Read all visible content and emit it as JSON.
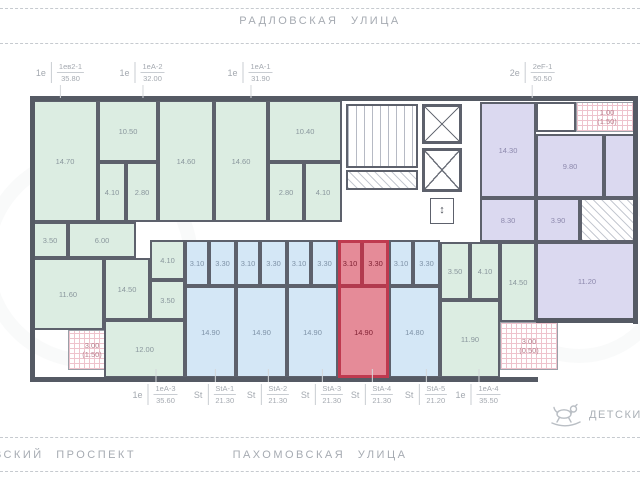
{
  "streets": {
    "top": "РАДЛОВСКАЯ УЛИЦА",
    "bottom_left": "ВСКИЙ ПРОСПЕКТ",
    "bottom_center": "ПАХОМОВСКАЯ УЛИЦА"
  },
  "poi": {
    "label": "ДЕТСКИЙ",
    "icon": "rocking-horse-icon"
  },
  "colors": {
    "green_room": "#dcede2",
    "blue_room": "#d4e7f6",
    "purple_room": "#dbd9f0",
    "highlight_red": "#e58b98",
    "highlight_border": "#bf3a4f",
    "wall": "#555a64",
    "street_text": "#a6abb2"
  },
  "top_units": [
    {
      "type": "1е",
      "code": "1ев2-1",
      "area": "35.80",
      "cx": 60
    },
    {
      "type": "1е",
      "code": "1еА-2",
      "area": "32.00",
      "cx": 142
    },
    {
      "type": "1е",
      "code": "1еА-1",
      "area": "31.90",
      "cx": 250
    },
    {
      "type": "2е",
      "code": "2еF-1",
      "area": "50.50",
      "cx": 532
    }
  ],
  "bottom_units": [
    {
      "type": "1е",
      "code": "1еА-3",
      "area": "35.60",
      "cx": 155
    },
    {
      "type": "St",
      "code": "StА-1",
      "area": "21.30",
      "cx": 215
    },
    {
      "type": "St",
      "code": "StА-2",
      "area": "21.30",
      "cx": 268
    },
    {
      "type": "St",
      "code": "StА-3",
      "area": "21.30",
      "cx": 322
    },
    {
      "type": "St",
      "code": "StА-4",
      "area": "21.30",
      "cx": 372
    },
    {
      "type": "St",
      "code": "StА-5",
      "area": "21.20",
      "cx": 426
    },
    {
      "type": "1е",
      "code": "1еА-4",
      "area": "35.50",
      "cx": 478
    }
  ],
  "plan": {
    "rooms": [
      {
        "t": "14.70",
        "x": 32,
        "y": 100,
        "w": 66,
        "h": 122,
        "c": "green"
      },
      {
        "t": "10.50",
        "x": 98,
        "y": 100,
        "w": 60,
        "h": 62,
        "c": "green"
      },
      {
        "t": "4.10",
        "x": 98,
        "y": 162,
        "w": 28,
        "h": 60,
        "c": "green"
      },
      {
        "t": "2.80",
        "x": 126,
        "y": 162,
        "w": 32,
        "h": 60,
        "c": "green"
      },
      {
        "t": "14.60",
        "x": 158,
        "y": 100,
        "w": 56,
        "h": 122,
        "c": "green"
      },
      {
        "t": "14.60",
        "x": 214,
        "y": 100,
        "w": 54,
        "h": 122,
        "c": "green"
      },
      {
        "t": "10.40",
        "x": 268,
        "y": 100,
        "w": 74,
        "h": 62,
        "c": "green"
      },
      {
        "t": "2.80",
        "x": 268,
        "y": 162,
        "w": 36,
        "h": 60,
        "c": "green"
      },
      {
        "t": "4.10",
        "x": 304,
        "y": 162,
        "w": 38,
        "h": 60,
        "c": "green"
      },
      {
        "t": "",
        "x": 346,
        "y": 104,
        "w": 72,
        "h": 64,
        "c": "stairs"
      },
      {
        "t": "",
        "x": 346,
        "y": 170,
        "w": 72,
        "h": 20,
        "c": "hatch"
      },
      {
        "t": "",
        "x": 422,
        "y": 104,
        "w": 40,
        "h": 40,
        "c": "elev"
      },
      {
        "t": "",
        "x": 422,
        "y": 148,
        "w": 40,
        "h": 44,
        "c": "elev"
      },
      {
        "t": "↕",
        "x": 430,
        "y": 198,
        "w": 24,
        "h": 26,
        "c": "sign"
      },
      {
        "t": "14.30",
        "x": 480,
        "y": 102,
        "w": 56,
        "h": 96,
        "c": "purple"
      },
      {
        "t": "",
        "x": 536,
        "y": 102,
        "w": 40,
        "h": 30,
        "c": "white"
      },
      {
        "t": "1.00|(1.50)",
        "x": 576,
        "y": 102,
        "w": 62,
        "h": 30,
        "c": "hatchpink"
      },
      {
        "t": "9.80",
        "x": 536,
        "y": 134,
        "w": 68,
        "h": 64,
        "c": "purple"
      },
      {
        "t": "",
        "x": 604,
        "y": 134,
        "w": 34,
        "h": 64,
        "c": "purple"
      },
      {
        "t": "8.30",
        "x": 480,
        "y": 198,
        "w": 56,
        "h": 44,
        "c": "purple"
      },
      {
        "t": "3.90",
        "x": 536,
        "y": 198,
        "w": 44,
        "h": 44,
        "c": "purple"
      },
      {
        "t": "",
        "x": 580,
        "y": 198,
        "w": 58,
        "h": 44,
        "c": "hatch"
      },
      {
        "t": "11.20",
        "x": 536,
        "y": 242,
        "w": 102,
        "h": 78,
        "c": "purple"
      },
      {
        "t": "3.50",
        "x": 32,
        "y": 222,
        "w": 36,
        "h": 36,
        "c": "green"
      },
      {
        "t": "6.00",
        "x": 68,
        "y": 222,
        "w": 68,
        "h": 36,
        "c": "green"
      },
      {
        "t": "11.60",
        "x": 32,
        "y": 258,
        "w": 72,
        "h": 72,
        "c": "green"
      },
      {
        "t": "3.00|(1.50)",
        "x": 68,
        "y": 330,
        "w": 48,
        "h": 40,
        "c": "hatchpink"
      },
      {
        "t": "14.50",
        "x": 104,
        "y": 258,
        "w": 46,
        "h": 62,
        "c": "green"
      },
      {
        "t": "4.10",
        "x": 150,
        "y": 240,
        "w": 35,
        "h": 40,
        "c": "green"
      },
      {
        "t": "3.50",
        "x": 150,
        "y": 280,
        "w": 35,
        "h": 40,
        "c": "green"
      },
      {
        "t": "12.00",
        "x": 104,
        "y": 320,
        "w": 81,
        "h": 58,
        "c": "green"
      },
      {
        "t": "3.10",
        "x": 185,
        "y": 240,
        "w": 24,
        "h": 46,
        "c": "blue"
      },
      {
        "t": "3.30",
        "x": 209,
        "y": 240,
        "w": 27,
        "h": 46,
        "c": "blue"
      },
      {
        "t": "14.90",
        "x": 185,
        "y": 286,
        "w": 51,
        "h": 92,
        "c": "blue"
      },
      {
        "t": "3.10",
        "x": 236,
        "y": 240,
        "w": 24,
        "h": 46,
        "c": "blue"
      },
      {
        "t": "3.30",
        "x": 260,
        "y": 240,
        "w": 27,
        "h": 46,
        "c": "blue"
      },
      {
        "t": "14.90",
        "x": 236,
        "y": 286,
        "w": 51,
        "h": 92,
        "c": "blue"
      },
      {
        "t": "3.10",
        "x": 287,
        "y": 240,
        "w": 24,
        "h": 46,
        "c": "blue"
      },
      {
        "t": "3.30",
        "x": 311,
        "y": 240,
        "w": 27,
        "h": 46,
        "c": "blue"
      },
      {
        "t": "14.90",
        "x": 287,
        "y": 286,
        "w": 51,
        "h": 92,
        "c": "blue"
      },
      {
        "t": "3.10",
        "x": 338,
        "y": 240,
        "w": 24,
        "h": 46,
        "c": "red"
      },
      {
        "t": "3.30",
        "x": 362,
        "y": 240,
        "w": 27,
        "h": 46,
        "c": "red"
      },
      {
        "t": "14.90",
        "x": 338,
        "y": 286,
        "w": 51,
        "h": 92,
        "c": "red"
      },
      {
        "t": "",
        "x": 338,
        "y": 240,
        "w": 51,
        "h": 138,
        "c": "redline"
      },
      {
        "t": "3.10",
        "x": 389,
        "y": 240,
        "w": 24,
        "h": 46,
        "c": "blue"
      },
      {
        "t": "3.30",
        "x": 413,
        "y": 240,
        "w": 27,
        "h": 46,
        "c": "blue"
      },
      {
        "t": "14.80",
        "x": 389,
        "y": 286,
        "w": 51,
        "h": 92,
        "c": "blue"
      },
      {
        "t": "3.50",
        "x": 440,
        "y": 242,
        "w": 30,
        "h": 58,
        "c": "green"
      },
      {
        "t": "4.10",
        "x": 470,
        "y": 242,
        "w": 30,
        "h": 58,
        "c": "green"
      },
      {
        "t": "14.50",
        "x": 500,
        "y": 242,
        "w": 36,
        "h": 80,
        "c": "green"
      },
      {
        "t": "11.90",
        "x": 440,
        "y": 300,
        "w": 60,
        "h": 78,
        "c": "green"
      },
      {
        "t": "3.00|(0.50)",
        "x": 500,
        "y": 322,
        "w": 58,
        "h": 48,
        "c": "hatchpink"
      }
    ],
    "walls": [
      {
        "x": 30,
        "y": 96,
        "w": 608,
        "h": 5
      },
      {
        "x": 30,
        "y": 96,
        "w": 5,
        "h": 286
      },
      {
        "x": 633,
        "y": 96,
        "w": 5,
        "h": 228
      },
      {
        "x": 30,
        "y": 377,
        "w": 508,
        "h": 5
      },
      {
        "x": 536,
        "y": 318,
        "w": 102,
        "h": 5
      }
    ]
  }
}
